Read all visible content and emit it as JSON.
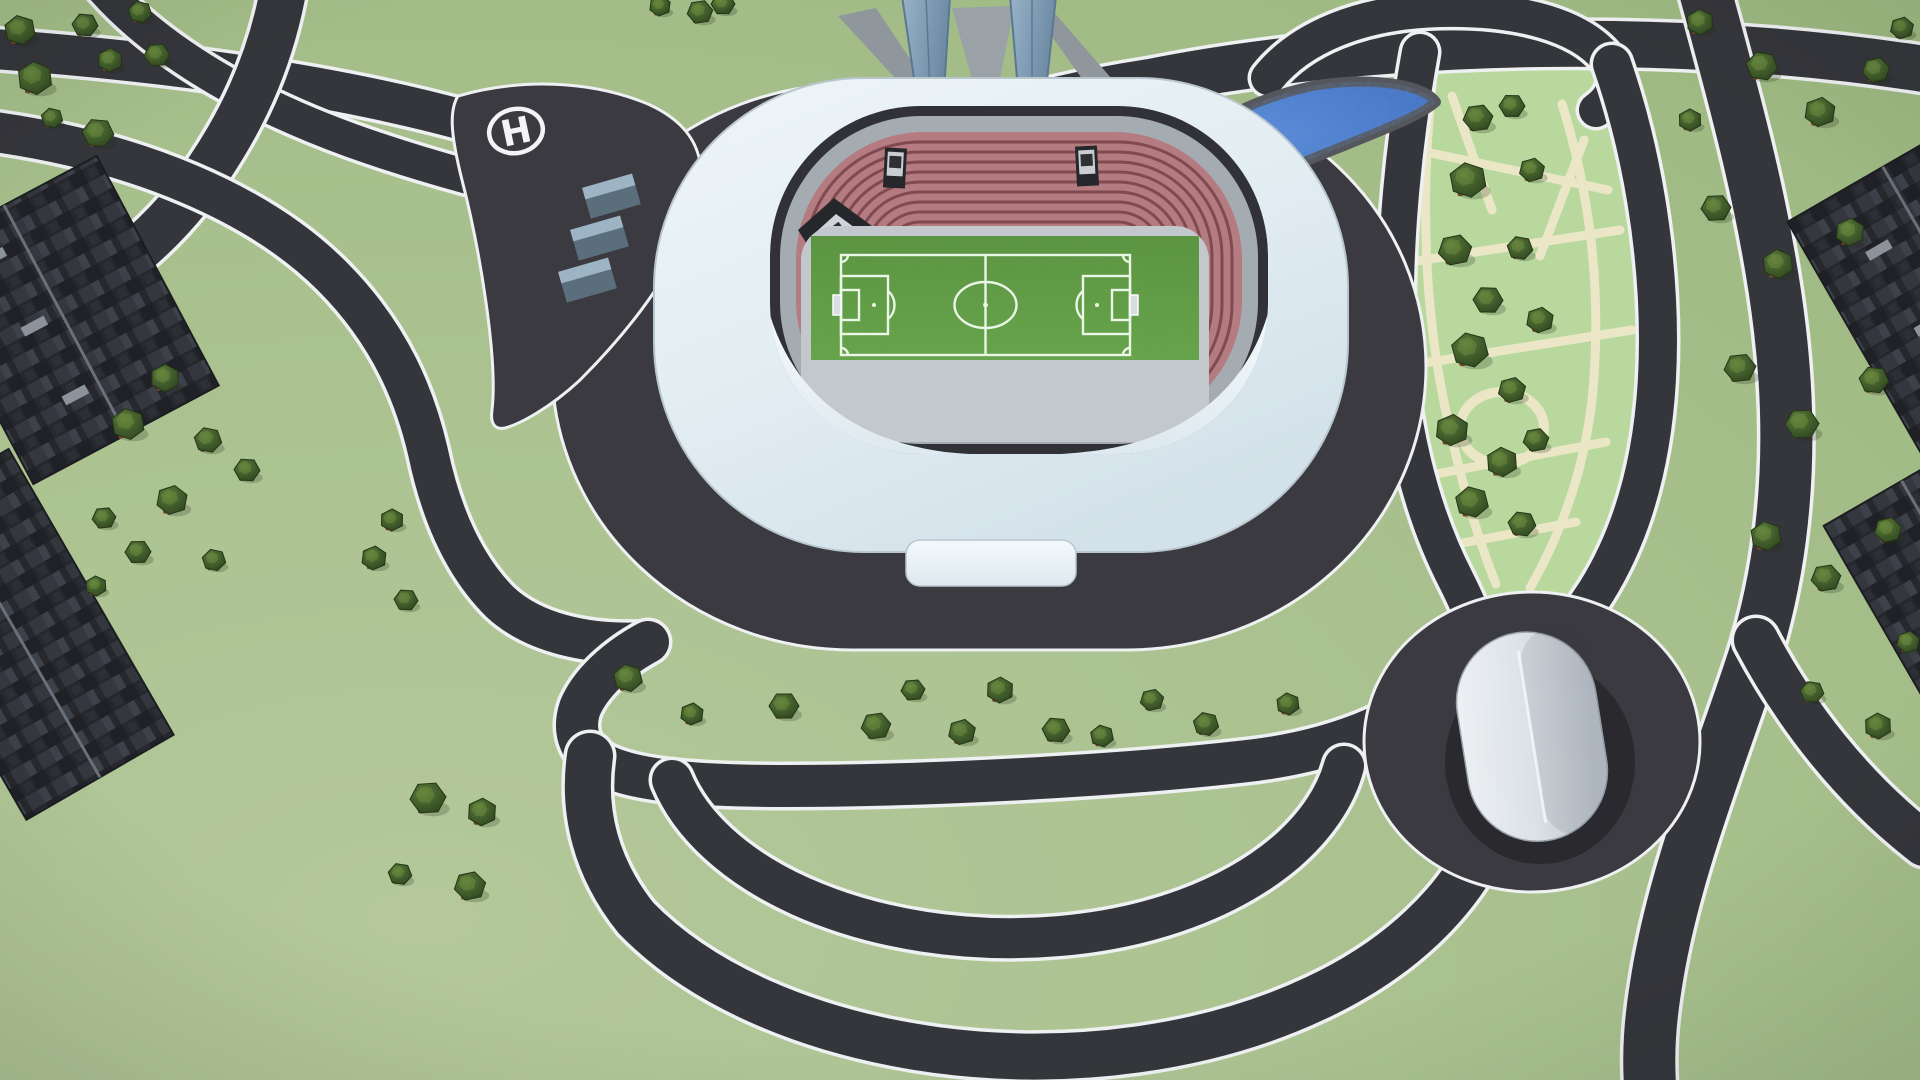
{
  "scene": {
    "title": "Stadium district aerial 3D map",
    "helipad": {
      "marking": "H"
    },
    "landmarks": {
      "stadium": "football-stadium",
      "pond": "water-pond",
      "park": "tree-park",
      "arena": "small-arena-hall",
      "helipad": "helipad-platform"
    }
  },
  "palette": {
    "grass": "#a6bf8b",
    "grass_light": "#b4c89a",
    "road": "#35363b",
    "road_edge": "#eef0f1",
    "apron": "#3b3a40",
    "roof_light": "#ebf3f7",
    "roof_dark": "#d6e3ec",
    "seats": "#b47b81",
    "seat_stripe": "#7f4b51",
    "concourse": "#a4abb1",
    "walkway": "#c3c8cc",
    "pitch": "#63a247",
    "pitch_line": "#eaf6e6",
    "water": "#4f82d8",
    "water_deep": "#2f5cb0",
    "park": "#b8d89e",
    "park_path": "#ebe7c6",
    "tree_canopy": "#3f5c2b",
    "tree_trunk": "#7c4526",
    "building": "#2a2c32",
    "arena": "#dfe5ea",
    "tower_glass": "#87a4bb"
  },
  "trees": [
    [
      20,
      30,
      16
    ],
    [
      85,
      25,
      13
    ],
    [
      140,
      12,
      12
    ],
    [
      35,
      78,
      18
    ],
    [
      110,
      60,
      13
    ],
    [
      157,
      55,
      13
    ],
    [
      98,
      133,
      16
    ],
    [
      52,
      118,
      11
    ],
    [
      700,
      12,
      13
    ],
    [
      660,
      6,
      11
    ],
    [
      723,
      4,
      12
    ],
    [
      165,
      378,
      15
    ],
    [
      128,
      424,
      17
    ],
    [
      208,
      440,
      14
    ],
    [
      247,
      470,
      13
    ],
    [
      172,
      500,
      16
    ],
    [
      138,
      552,
      13
    ],
    [
      104,
      518,
      12
    ],
    [
      214,
      560,
      12
    ],
    [
      96,
      586,
      11
    ],
    [
      392,
      520,
      12
    ],
    [
      374,
      558,
      13
    ],
    [
      406,
      600,
      12
    ],
    [
      428,
      798,
      18
    ],
    [
      482,
      812,
      15
    ],
    [
      470,
      886,
      16
    ],
    [
      400,
      874,
      12
    ],
    [
      628,
      678,
      15
    ],
    [
      692,
      714,
      12
    ],
    [
      784,
      706,
      15
    ],
    [
      876,
      726,
      15
    ],
    [
      913,
      690,
      12
    ],
    [
      962,
      732,
      14
    ],
    [
      1000,
      690,
      14
    ],
    [
      1056,
      730,
      14
    ],
    [
      1102,
      736,
      12
    ],
    [
      1152,
      700,
      12
    ],
    [
      1206,
      724,
      13
    ],
    [
      1288,
      704,
      12
    ],
    [
      1700,
      22,
      14
    ],
    [
      1762,
      66,
      16
    ],
    [
      1820,
      112,
      16
    ],
    [
      1876,
      70,
      14
    ],
    [
      1902,
      28,
      12
    ],
    [
      1690,
      120,
      12
    ],
    [
      1716,
      208,
      15
    ],
    [
      1778,
      264,
      16
    ],
    [
      1850,
      232,
      15
    ],
    [
      1740,
      368,
      16
    ],
    [
      1802,
      424,
      17
    ],
    [
      1874,
      380,
      15
    ],
    [
      1766,
      536,
      16
    ],
    [
      1826,
      578,
      15
    ],
    [
      1888,
      530,
      14
    ],
    [
      1878,
      726,
      14
    ],
    [
      1812,
      692,
      12
    ],
    [
      1908,
      642,
      12
    ],
    [
      1478,
      118,
      15
    ],
    [
      1512,
      106,
      13
    ],
    [
      1468,
      180,
      19
    ],
    [
      1532,
      170,
      13
    ],
    [
      1455,
      250,
      17
    ],
    [
      1520,
      248,
      13
    ],
    [
      1488,
      300,
      15
    ],
    [
      1540,
      320,
      14
    ],
    [
      1470,
      350,
      19
    ],
    [
      1512,
      390,
      14
    ],
    [
      1452,
      430,
      17
    ],
    [
      1502,
      462,
      16
    ],
    [
      1536,
      440,
      13
    ],
    [
      1472,
      502,
      17
    ],
    [
      1522,
      524,
      14
    ]
  ]
}
